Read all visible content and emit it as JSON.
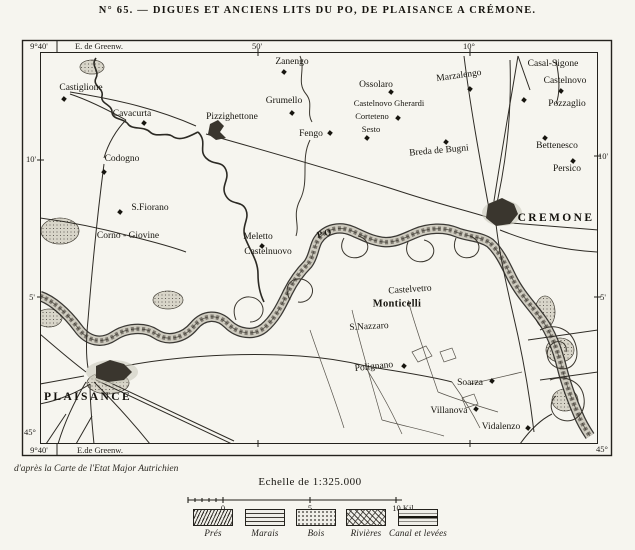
{
  "title": "N° 65. — DIGUES ET ANCIENS LITS DU PO, DE PLAISANCE A CRÉMONE.",
  "attribution": "d'après la Carte de l'Etat Major Autrichien",
  "colors": {
    "paper": "#f6f5ef",
    "ink": "#1d1b17",
    "river_fill": "#cfccc0",
    "river_edge": "#26241f"
  },
  "graticule": [
    {
      "label": "9°40'",
      "x": 39,
      "y": 46
    },
    {
      "label": "E. de Greenw.",
      "x": 99,
      "y": 46
    },
    {
      "label": "50'",
      "x": 257,
      "y": 46
    },
    {
      "label": "10°",
      "x": 469,
      "y": 46
    },
    {
      "label": "10'",
      "x": 31,
      "y": 159
    },
    {
      "label": "5'",
      "x": 32,
      "y": 297
    },
    {
      "label": "45°",
      "x": 30,
      "y": 432
    },
    {
      "label": "9°40'",
      "x": 39,
      "y": 450
    },
    {
      "label": "E.de Greenw.",
      "x": 100,
      "y": 450
    },
    {
      "label": "10'",
      "x": 603,
      "y": 156
    },
    {
      "label": "5'",
      "x": 603,
      "y": 297
    },
    {
      "label": "45°",
      "x": 602,
      "y": 449
    }
  ],
  "places": [
    {
      "name": "Castiglione",
      "x": 81,
      "y": 88,
      "mx": 64,
      "my": 99
    },
    {
      "name": "Cavacurta",
      "x": 132,
      "y": 114,
      "mx": 144,
      "my": 123
    },
    {
      "name": "Pizzighettone",
      "x": 232,
      "y": 117
    },
    {
      "name": "Grumello",
      "x": 284,
      "y": 101,
      "mx": 292,
      "my": 113
    },
    {
      "name": "Fengo",
      "x": 311,
      "y": 134,
      "mx": 330,
      "my": 133
    },
    {
      "name": "Codogno",
      "x": 122,
      "y": 159,
      "mx": 104,
      "my": 172
    },
    {
      "name": "Zanengo",
      "x": 292,
      "y": 62,
      "mx": 284,
      "my": 72
    },
    {
      "name": "Ossolaro",
      "x": 376,
      "y": 85,
      "mx": 391,
      "my": 92
    },
    {
      "name": "Marzalengo",
      "x": 459,
      "y": 76,
      "rot": -8,
      "mx": 470,
      "my": 89
    },
    {
      "name": "Casal-Sigone",
      "x": 553,
      "y": 64
    },
    {
      "name": "Castelnovo",
      "x": 565,
      "y": 81,
      "mx": 561,
      "my": 91
    },
    {
      "name": "Pozzaglio",
      "x": 567,
      "y": 104,
      "mx": 524,
      "my": 100
    },
    {
      "name": "Castelnovo Gherardi",
      "x": 389,
      "y": 103,
      "cls": "sm"
    },
    {
      "name": "Corteteno",
      "x": 372,
      "y": 116,
      "cls": "sm",
      "mx": 398,
      "my": 118
    },
    {
      "name": "Sesto",
      "x": 371,
      "y": 129,
      "cls": "sm",
      "mx": 367,
      "my": 138
    },
    {
      "name": "Breda de Bugni",
      "x": 439,
      "y": 151,
      "rot": -5,
      "mx": 446,
      "my": 142
    },
    {
      "name": "Bettenesco",
      "x": 557,
      "y": 146,
      "mx": 545,
      "my": 138
    },
    {
      "name": "Persico",
      "x": 567,
      "y": 169,
      "mx": 573,
      "my": 161
    },
    {
      "name": "S.Fiorano",
      "x": 150,
      "y": 208,
      "mx": 120,
      "my": 212
    },
    {
      "name": "Corno - Giovine",
      "x": 128,
      "y": 236
    },
    {
      "name": "Meletto",
      "x": 258,
      "y": 237,
      "mx": 262,
      "my": 246
    },
    {
      "name": "Castelnuovo",
      "x": 268,
      "y": 252
    },
    {
      "name": "PO",
      "x": 325,
      "y": 233,
      "cls": "r",
      "rot": -14
    },
    {
      "name": "CREMONE",
      "x": 556,
      "y": 218,
      "cls": "c"
    },
    {
      "name": "Castelvetro",
      "x": 410,
      "y": 290,
      "rot": -4
    },
    {
      "name": "Monticelli",
      "x": 397,
      "y": 304,
      "cls": "md"
    },
    {
      "name": "S.Nazzaro",
      "x": 369,
      "y": 327,
      "rot": -3
    },
    {
      "name": "Polignano",
      "x": 374,
      "y": 367,
      "rot": -6,
      "mx": 404,
      "my": 366
    },
    {
      "name": "Soarza",
      "x": 470,
      "y": 383,
      "mx": 492,
      "my": 381
    },
    {
      "name": "Villanova",
      "x": 449,
      "y": 411,
      "mx": 476,
      "my": 409
    },
    {
      "name": "Vidalenzo",
      "x": 501,
      "y": 427,
      "mx": 528,
      "my": 428
    },
    {
      "name": "PLAISANCE",
      "x": 88,
      "y": 397,
      "cls": "c"
    }
  ],
  "scale": {
    "heading": "Echelle de 1:325.000",
    "ticks": [
      {
        "label": "0",
        "x": 223
      },
      {
        "label": "5",
        "x": 310
      },
      {
        "label": "10 Kil.",
        "x": 404
      }
    ]
  },
  "legend": {
    "items": [
      {
        "label": "Prés",
        "pattern": "pres",
        "x": 213
      },
      {
        "label": "Marais",
        "pattern": "marais",
        "x": 265
      },
      {
        "label": "Bois",
        "pattern": "bois",
        "x": 316
      },
      {
        "label": "Rivières",
        "pattern": "rivieres",
        "x": 366
      },
      {
        "label": "Canal et levées",
        "pattern": "canal",
        "x": 418
      }
    ]
  }
}
